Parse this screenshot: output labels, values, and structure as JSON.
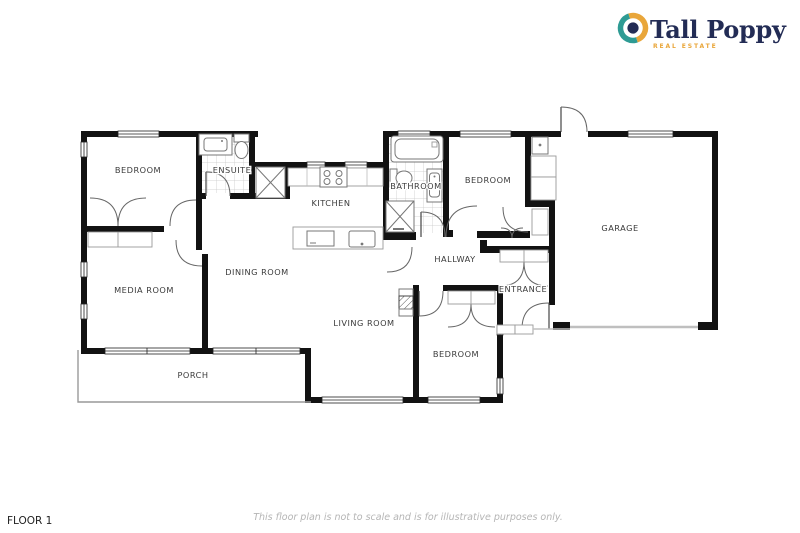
{
  "logo": {
    "brand": "Tall Poppy",
    "tagline": "REAL ESTATE",
    "color_teal": "#2E9B94",
    "color_gold": "#E9A63A",
    "color_navy": "#232C55"
  },
  "plan": {
    "rooms": [
      {
        "id": "bedroom-1",
        "label": "BEDROOM"
      },
      {
        "id": "ensuite",
        "label": "ENSUITE"
      },
      {
        "id": "kitchen",
        "label": "KITCHEN"
      },
      {
        "id": "bathroom",
        "label": "BATHROOM"
      },
      {
        "id": "bedroom-2",
        "label": "BEDROOM"
      },
      {
        "id": "garage",
        "label": "GARAGE"
      },
      {
        "id": "media-room",
        "label": "MEDIA ROOM"
      },
      {
        "id": "dining-room",
        "label": "DINING ROOM"
      },
      {
        "id": "hallway",
        "label": "HALLWAY"
      },
      {
        "id": "entrance",
        "label": "ENTRANCE"
      },
      {
        "id": "living-room",
        "label": "LIVING ROOM"
      },
      {
        "id": "bedroom-3",
        "label": "BEDROOM"
      },
      {
        "id": "porch",
        "label": "PORCH"
      }
    ]
  },
  "footer": {
    "floor": "FLOOR 1",
    "disclaimer": "This floor plan is not to scale and is for illustrative purposes only."
  }
}
